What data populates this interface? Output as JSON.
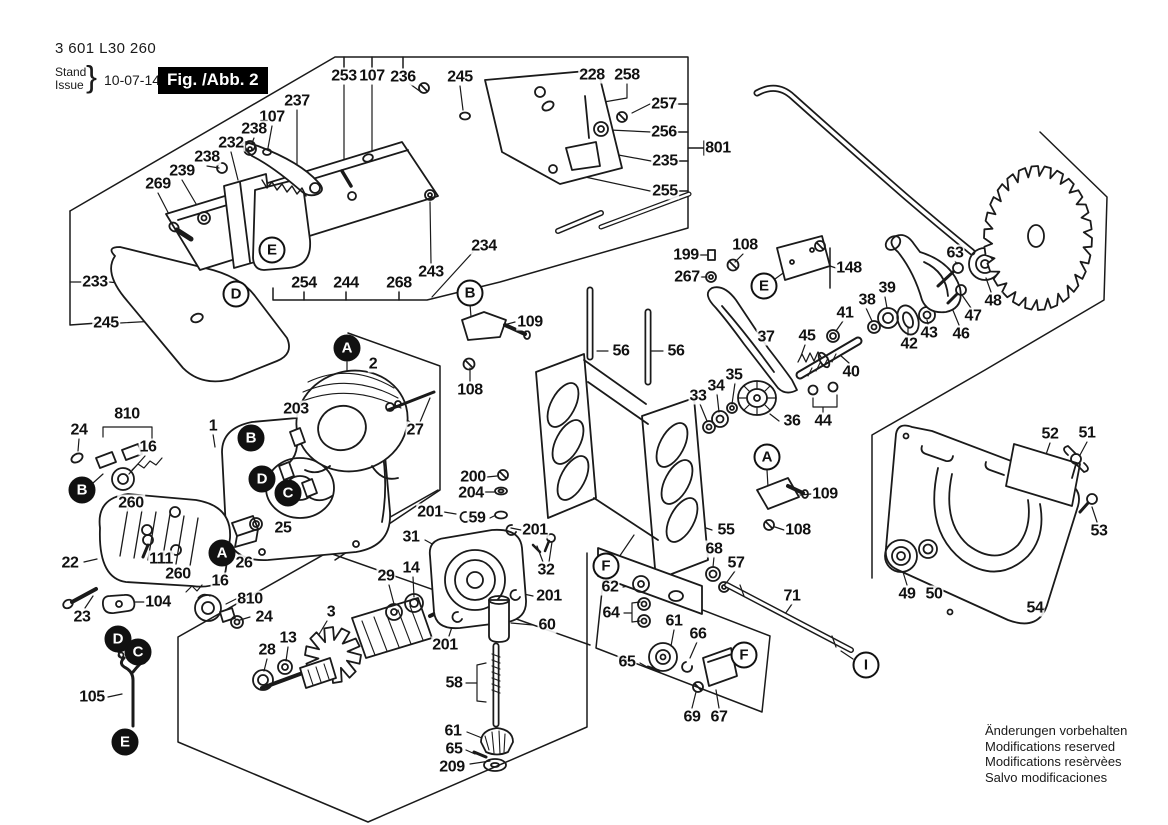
{
  "meta": {
    "part_number": "3 601 L30 260",
    "stand_label": "Stand",
    "issue_label": "Issue",
    "brace": "}",
    "date": "10-07-14",
    "figure_label": "Fig. /Abb. 2"
  },
  "notices": {
    "lines": [
      "Änderungen vorbehalten",
      "Modifications reserved",
      "Modifications resèrvèes",
      "Salvo modificaciones"
    ]
  },
  "colors": {
    "ink": "#1a1a1a",
    "background": "#ffffff",
    "figure_box_bg": "#000000",
    "figure_box_text": "#ffffff"
  },
  "part_labels": [
    {
      "text": "253",
      "x": 344,
      "y": 76
    },
    {
      "text": "107",
      "x": 372,
      "y": 76
    },
    {
      "text": "236",
      "x": 403,
      "y": 77
    },
    {
      "text": "245",
      "x": 460,
      "y": 77
    },
    {
      "text": "228",
      "x": 592,
      "y": 75
    },
    {
      "text": "258",
      "x": 627,
      "y": 75
    },
    {
      "text": "257",
      "x": 664,
      "y": 104
    },
    {
      "text": "256",
      "x": 664,
      "y": 132
    },
    {
      "text": "801",
      "x": 718,
      "y": 148
    },
    {
      "text": "235",
      "x": 665,
      "y": 161
    },
    {
      "text": "255",
      "x": 665,
      "y": 191
    },
    {
      "text": "237",
      "x": 297,
      "y": 101
    },
    {
      "text": "107",
      "x": 272,
      "y": 117
    },
    {
      "text": "238",
      "x": 254,
      "y": 129
    },
    {
      "text": "232",
      "x": 231,
      "y": 143
    },
    {
      "text": "238",
      "x": 207,
      "y": 157
    },
    {
      "text": "239",
      "x": 182,
      "y": 171
    },
    {
      "text": "269",
      "x": 158,
      "y": 184
    },
    {
      "text": "233",
      "x": 95,
      "y": 282
    },
    {
      "text": "245",
      "x": 106,
      "y": 323
    },
    {
      "text": "254",
      "x": 304,
      "y": 283
    },
    {
      "text": "244",
      "x": 346,
      "y": 283
    },
    {
      "text": "268",
      "x": 399,
      "y": 283
    },
    {
      "text": "243",
      "x": 431,
      "y": 272
    },
    {
      "text": "234",
      "x": 484,
      "y": 246
    },
    {
      "text": "109",
      "x": 530,
      "y": 322
    },
    {
      "text": "108",
      "x": 470,
      "y": 390
    },
    {
      "text": "56",
      "x": 621,
      "y": 351
    },
    {
      "text": "56",
      "x": 676,
      "y": 351
    },
    {
      "text": "199",
      "x": 686,
      "y": 255
    },
    {
      "text": "108",
      "x": 745,
      "y": 245
    },
    {
      "text": "267",
      "x": 687,
      "y": 277
    },
    {
      "text": "148",
      "x": 849,
      "y": 268
    },
    {
      "text": "37",
      "x": 766,
      "y": 337
    },
    {
      "text": "45",
      "x": 807,
      "y": 336
    },
    {
      "text": "41",
      "x": 845,
      "y": 313
    },
    {
      "text": "38",
      "x": 867,
      "y": 300
    },
    {
      "text": "39",
      "x": 887,
      "y": 288
    },
    {
      "text": "42",
      "x": 909,
      "y": 344
    },
    {
      "text": "43",
      "x": 929,
      "y": 333
    },
    {
      "text": "46",
      "x": 961,
      "y": 334
    },
    {
      "text": "47",
      "x": 973,
      "y": 316
    },
    {
      "text": "48",
      "x": 993,
      "y": 301
    },
    {
      "text": "63",
      "x": 955,
      "y": 253
    },
    {
      "text": "40",
      "x": 851,
      "y": 372
    },
    {
      "text": "33",
      "x": 698,
      "y": 396
    },
    {
      "text": "34",
      "x": 716,
      "y": 386
    },
    {
      "text": "35",
      "x": 734,
      "y": 375
    },
    {
      "text": "36",
      "x": 792,
      "y": 421
    },
    {
      "text": "44",
      "x": 823,
      "y": 421
    },
    {
      "text": "109",
      "x": 825,
      "y": 494
    },
    {
      "text": "108",
      "x": 798,
      "y": 530
    },
    {
      "text": "810",
      "x": 127,
      "y": 414
    },
    {
      "text": "24",
      "x": 79,
      "y": 430
    },
    {
      "text": "16",
      "x": 148,
      "y": 447
    },
    {
      "text": "260",
      "x": 131,
      "y": 503
    },
    {
      "text": "1",
      "x": 213,
      "y": 426
    },
    {
      "text": "203",
      "x": 296,
      "y": 409
    },
    {
      "text": "2",
      "x": 373,
      "y": 364
    },
    {
      "text": "27",
      "x": 415,
      "y": 430
    },
    {
      "text": "22",
      "x": 70,
      "y": 563
    },
    {
      "text": "111",
      "x": 161,
      "y": 559
    },
    {
      "text": "25",
      "x": 283,
      "y": 528
    },
    {
      "text": "26",
      "x": 244,
      "y": 563
    },
    {
      "text": "260",
      "x": 178,
      "y": 574
    },
    {
      "text": "16",
      "x": 220,
      "y": 581
    },
    {
      "text": "104",
      "x": 158,
      "y": 602
    },
    {
      "text": "23",
      "x": 82,
      "y": 617
    },
    {
      "text": "810",
      "x": 250,
      "y": 599
    },
    {
      "text": "24",
      "x": 264,
      "y": 617
    },
    {
      "text": "105",
      "x": 92,
      "y": 697
    },
    {
      "text": "28",
      "x": 267,
      "y": 650
    },
    {
      "text": "13",
      "x": 288,
      "y": 638
    },
    {
      "text": "3",
      "x": 331,
      "y": 612
    },
    {
      "text": "200",
      "x": 473,
      "y": 477
    },
    {
      "text": "204",
      "x": 471,
      "y": 493
    },
    {
      "text": "201",
      "x": 430,
      "y": 512
    },
    {
      "text": "59",
      "x": 477,
      "y": 518
    },
    {
      "text": "31",
      "x": 411,
      "y": 537
    },
    {
      "text": "29",
      "x": 386,
      "y": 576
    },
    {
      "text": "14",
      "x": 411,
      "y": 568
    },
    {
      "text": "201",
      "x": 535,
      "y": 530
    },
    {
      "text": "32",
      "x": 546,
      "y": 570
    },
    {
      "text": "201",
      "x": 549,
      "y": 596
    },
    {
      "text": "60",
      "x": 547,
      "y": 625
    },
    {
      "text": "201",
      "x": 445,
      "y": 645
    },
    {
      "text": "58",
      "x": 454,
      "y": 683
    },
    {
      "text": "61",
      "x": 453,
      "y": 731
    },
    {
      "text": "65",
      "x": 454,
      "y": 749
    },
    {
      "text": "209",
      "x": 452,
      "y": 767
    },
    {
      "text": "55",
      "x": 726,
      "y": 530
    },
    {
      "text": "68",
      "x": 714,
      "y": 549
    },
    {
      "text": "57",
      "x": 736,
      "y": 563
    },
    {
      "text": "62",
      "x": 610,
      "y": 587
    },
    {
      "text": "64",
      "x": 611,
      "y": 613
    },
    {
      "text": "71",
      "x": 792,
      "y": 596
    },
    {
      "text": "61",
      "x": 674,
      "y": 621
    },
    {
      "text": "66",
      "x": 698,
      "y": 634
    },
    {
      "text": "65",
      "x": 627,
      "y": 662
    },
    {
      "text": "69",
      "x": 692,
      "y": 717
    },
    {
      "text": "67",
      "x": 719,
      "y": 717
    },
    {
      "text": "52",
      "x": 1050,
      "y": 434
    },
    {
      "text": "51",
      "x": 1087,
      "y": 433
    },
    {
      "text": "53",
      "x": 1099,
      "y": 531
    },
    {
      "text": "54",
      "x": 1035,
      "y": 608
    },
    {
      "text": "49",
      "x": 907,
      "y": 594
    },
    {
      "text": "50",
      "x": 934,
      "y": 594
    }
  ],
  "callouts": [
    {
      "letter": "E",
      "x": 272,
      "y": 250,
      "style": "outlined"
    },
    {
      "letter": "D",
      "x": 236,
      "y": 294,
      "style": "outlined"
    },
    {
      "letter": "B",
      "x": 470,
      "y": 293,
      "style": "outlined"
    },
    {
      "letter": "E",
      "x": 764,
      "y": 286,
      "style": "outlined"
    },
    {
      "letter": "A",
      "x": 767,
      "y": 457,
      "style": "outlined"
    },
    {
      "letter": "F",
      "x": 606,
      "y": 566,
      "style": "outlined"
    },
    {
      "letter": "F",
      "x": 744,
      "y": 655,
      "style": "outlined"
    },
    {
      "letter": "I",
      "x": 866,
      "y": 665,
      "style": "outlined"
    },
    {
      "letter": "A",
      "x": 347,
      "y": 348,
      "style": "filled"
    },
    {
      "letter": "B",
      "x": 82,
      "y": 490,
      "style": "filled"
    },
    {
      "letter": "B",
      "x": 251,
      "y": 438,
      "style": "filled"
    },
    {
      "letter": "D",
      "x": 262,
      "y": 479,
      "style": "filled"
    },
    {
      "letter": "C",
      "x": 288,
      "y": 493,
      "style": "filled"
    },
    {
      "letter": "A",
      "x": 222,
      "y": 553,
      "style": "filled"
    },
    {
      "letter": "D",
      "x": 118,
      "y": 639,
      "style": "filled"
    },
    {
      "letter": "C",
      "x": 138,
      "y": 652,
      "style": "filled"
    },
    {
      "letter": "E",
      "x": 125,
      "y": 742,
      "style": "filled"
    }
  ]
}
